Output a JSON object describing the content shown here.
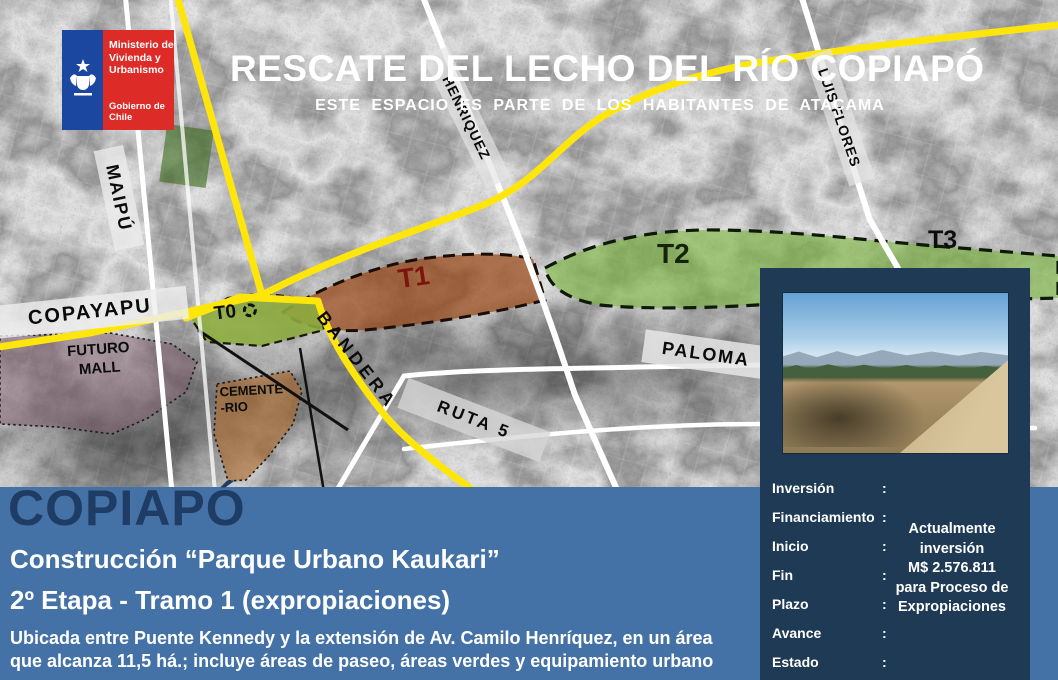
{
  "logo": {
    "ministry_lines": [
      "Ministerio de",
      "Vivienda y",
      "Urbanismo"
    ],
    "government": "Gobierno de Chile"
  },
  "header": {
    "title": "RESCATE DEL LECHO DEL RÍO COPIAPÓ",
    "subtitle": "ESTE ESPACIO ES PARTE DE LOS HABITANTES DE ATACAMA"
  },
  "map": {
    "road_labels": {
      "maipu": "MAIPÚ",
      "copayapu": "COPAYAPU",
      "henriquez": "HENRIQUEZ",
      "luis_flores": "LUIS FLORES",
      "bandera": "BANDERA",
      "ruta5": "RUTA 5",
      "paloma": "PALOMA"
    },
    "area_labels": {
      "futuro_mall_line1": "FUTURO",
      "futuro_mall_line2": "MALL",
      "cementerio_line1": "CEMENTE",
      "cementerio_line2": "-RIO"
    },
    "tramos": {
      "t0": "T0",
      "t1": "T1",
      "t2": "T2",
      "t3": "T3"
    }
  },
  "panel": {
    "info_labels": [
      "Inversión",
      "Financiamiento",
      "Inicio",
      "Fin",
      "Plazo",
      "Avance",
      "Estado"
    ],
    "colon": ":",
    "value_lines": [
      "Actualmente",
      "inversión",
      "M$ 2.576.811",
      "para  Proceso de",
      "Expropiaciones"
    ]
  },
  "footer": {
    "city": "COPIAPÓ",
    "project_line1": "Construcción “Parque Urbano Kaukari”",
    "project_line2": "2º Etapa - Tramo 1 (expropiaciones)",
    "description_line1": "Ubicada entre Puente Kennedy y la extensión de Av. Camilo Henríquez, en un área",
    "description_line2": "que alcanza  11,5 há.; incluye áreas de paseo, áreas verdes y equipamiento urbano"
  },
  "colors": {
    "band_blue": "#4472a6",
    "panel_navy": "#1e3a55",
    "logo_red": "#dd2b27",
    "logo_blue": "#1b47a0",
    "road_yellow": "#ffe60a",
    "tramo_green": "#7db54a",
    "tramo_brown": "#9c4a1e",
    "city_text_blue": "#1f3c64",
    "t1_label_red": "#7c160c"
  }
}
